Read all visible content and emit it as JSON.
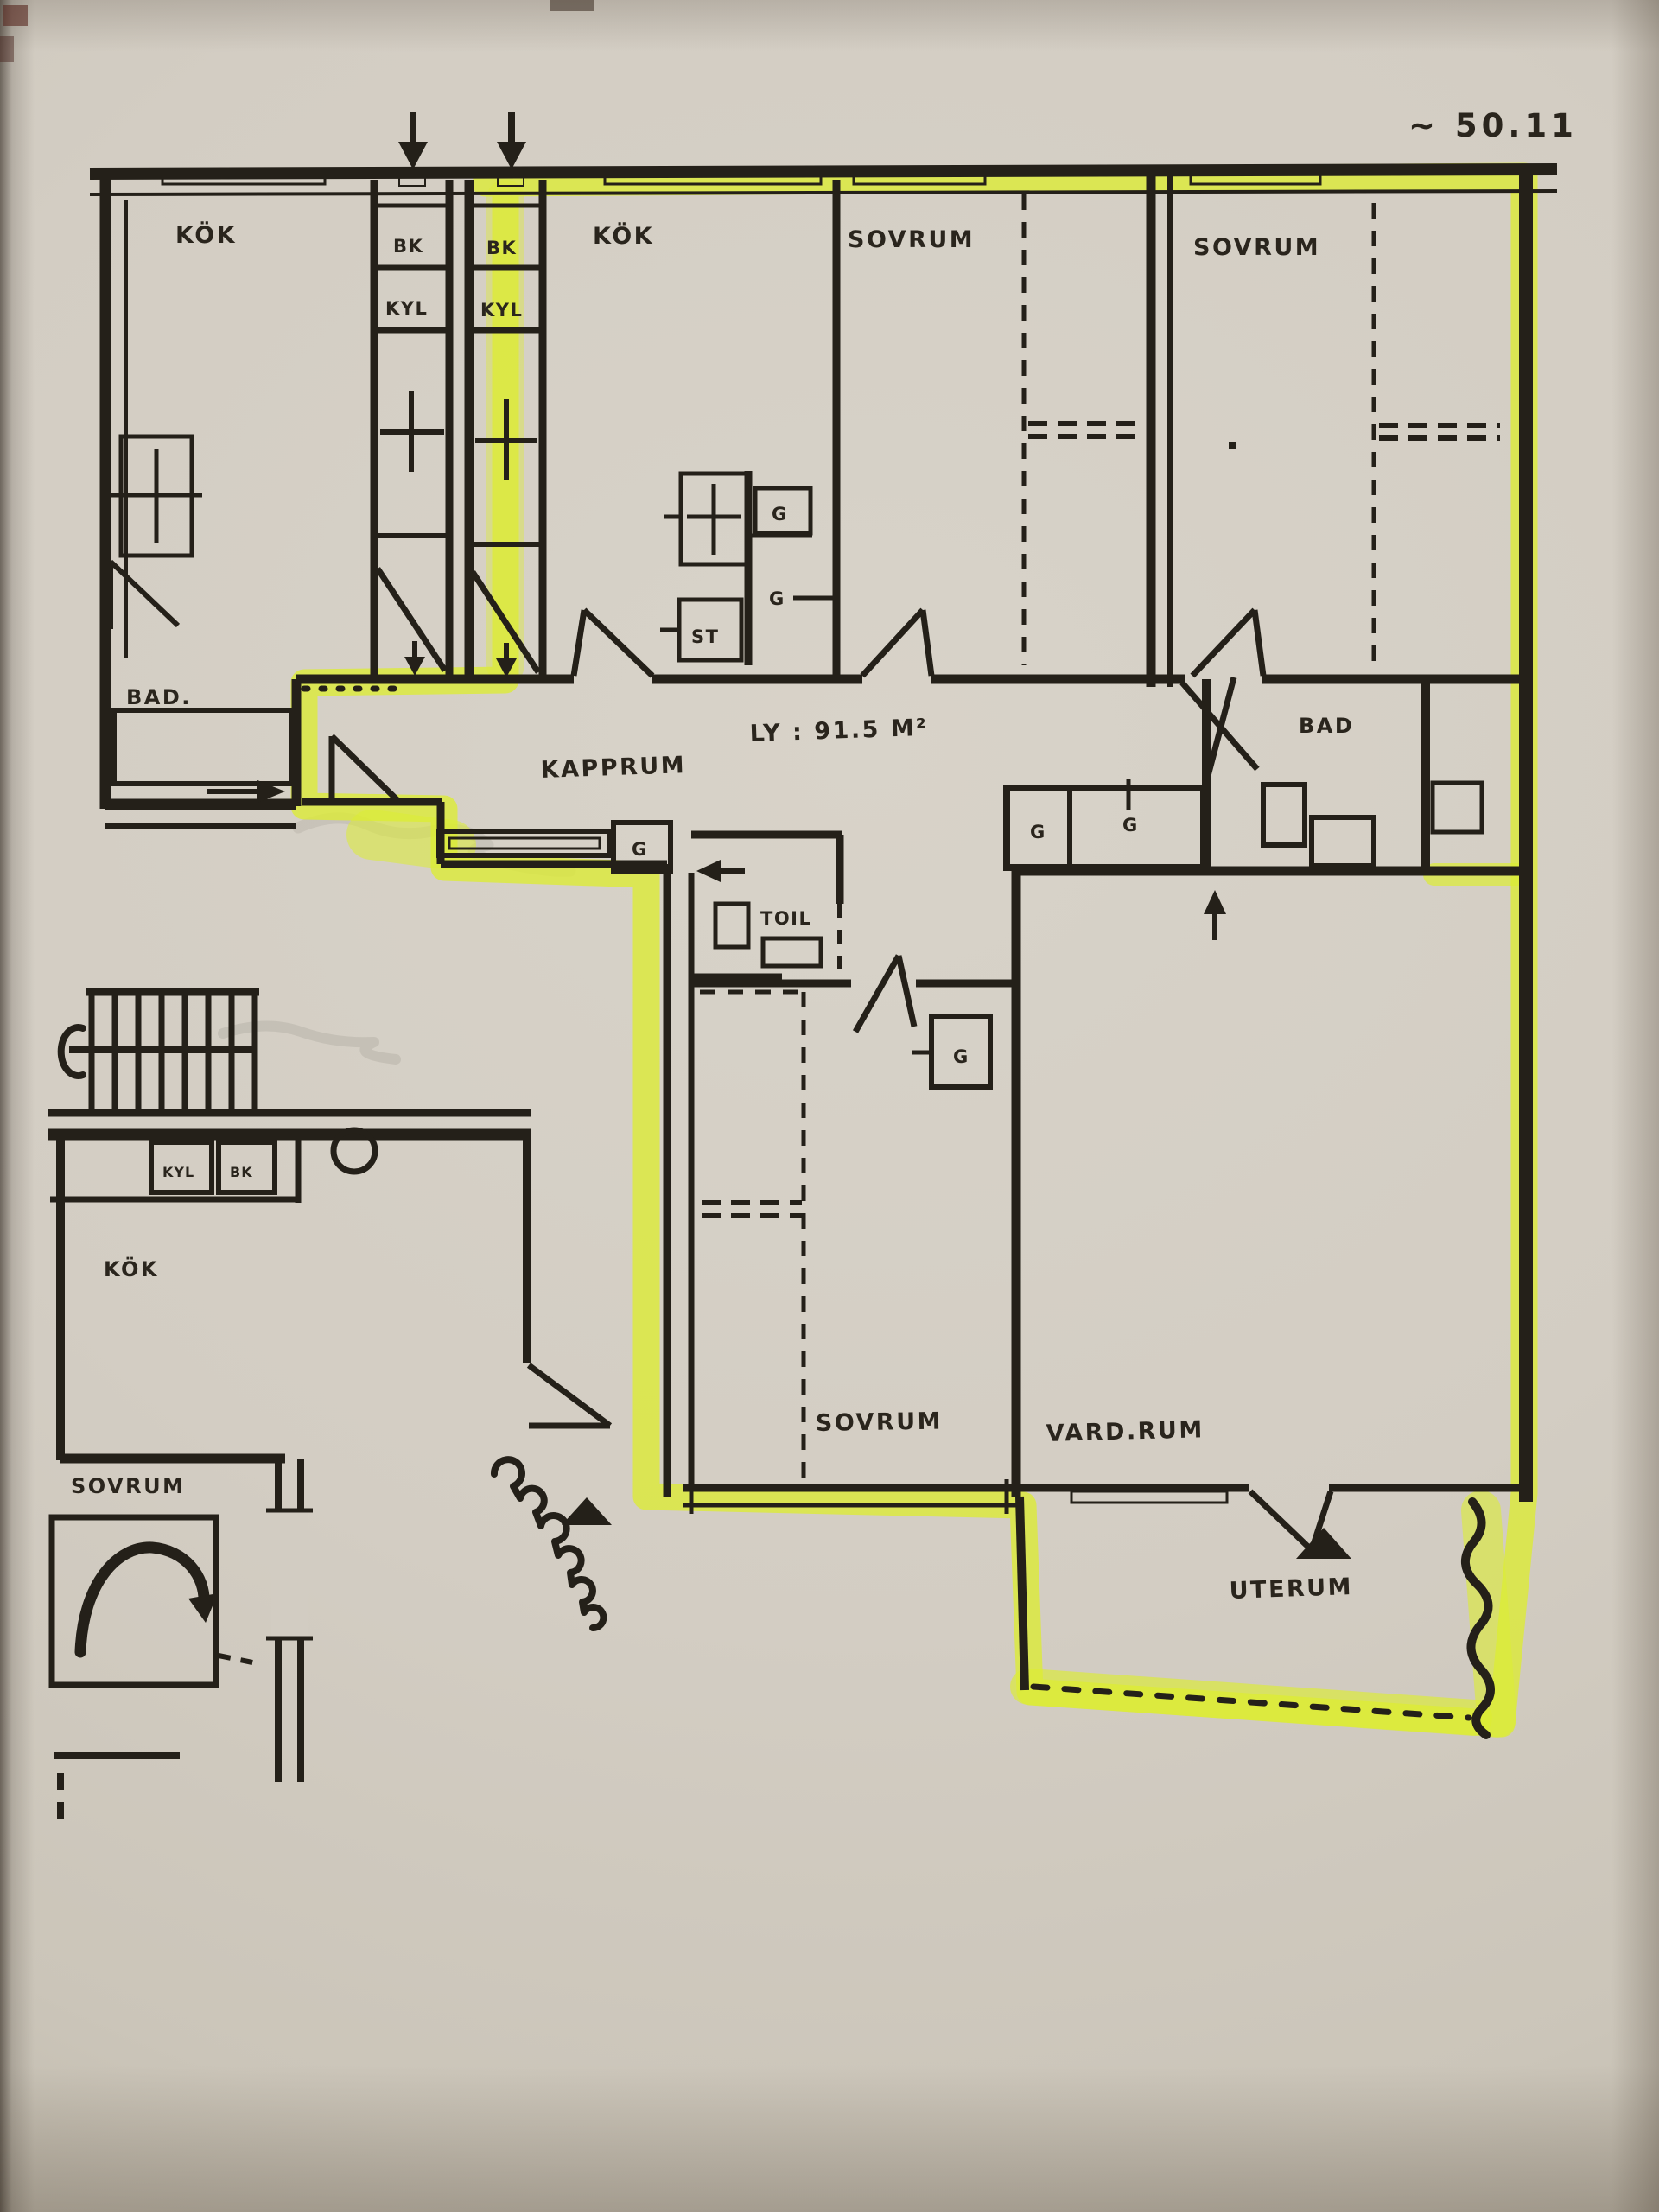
{
  "photo": {
    "paper_color": "#d3cdc3",
    "ink_color": "#242019",
    "highlight_color": "#dcec33"
  },
  "plan": {
    "scale_note": "~ 50.11",
    "area_note": "LY : 91.5 M²",
    "labels": {
      "kok": "KÖK",
      "sovrum": "SOVRUM",
      "bad_left": "BAD.",
      "bad_right": "BAD",
      "kapprum": "KAPPRUM",
      "vardrum": "VARD.RUM",
      "uterum": "UTERUM",
      "toil": "TOIL",
      "st": "ST",
      "g": "G",
      "kyl": "KYL",
      "bk": "BK"
    }
  }
}
